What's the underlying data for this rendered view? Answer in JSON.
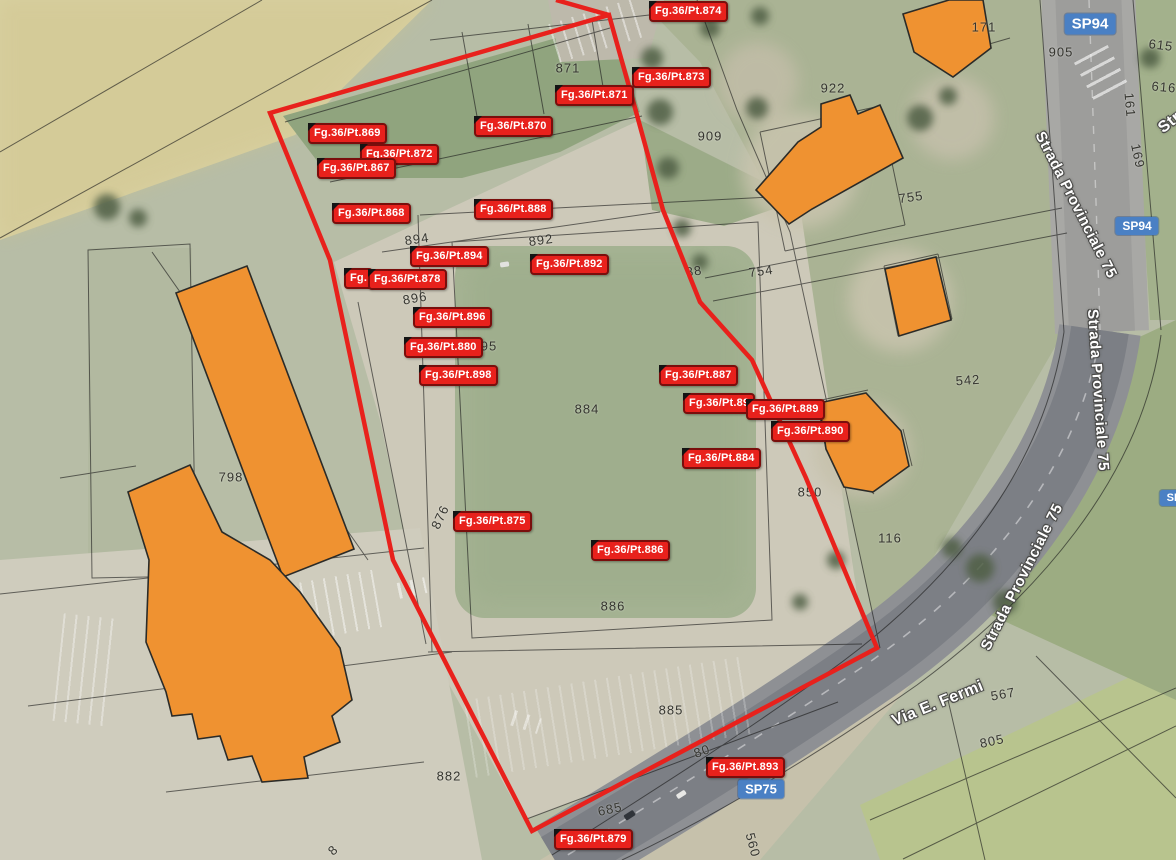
{
  "map": {
    "type": "cadastral-satellite-view",
    "colors": {
      "parcel_label_red": "#e8211c",
      "parcel_label_border": "#7a0e0c",
      "boundary_red": "#e8211c",
      "badge_blue": "#4a80c4",
      "building_orange": "#ef9231",
      "cadastral_line": "#1a1a1a"
    },
    "red_boundary": {
      "main": "M270,113 L609,15 L635,108 L663,210 L700,302 L752,360 L806,478 L877,648 L532,831 L393,560 L330,260 Z",
      "spur": "M556,0 L609,15"
    },
    "buildings": [
      {
        "id": "ne-corner",
        "points": "903,14 949,0 983,0 991,48 953,77 914,52"
      },
      {
        "id": "north-755",
        "points": "756,190 798,142 821,127 821,104 850,95 858,114 880,105 903,158 812,209 789,224 770,204"
      },
      {
        "id": "east-square",
        "points": "885,269 936,257 951,320 899,336"
      },
      {
        "id": "east-850",
        "points": "819,403 866,393 901,431 909,466 873,492 844,487 826,449"
      },
      {
        "id": "west-long-slab",
        "points": "176,293 247,266 354,549 283,577"
      },
      {
        "id": "west-complex",
        "points": "128,492 190,465 222,532 270,560 300,592 340,648 352,700 332,716 340,742 304,757 308,778 262,782 252,756 228,760 220,736 198,739 192,714 172,716 166,692 146,642 149,560"
      }
    ],
    "cadastral_labels": [
      {
        "text": "Fg.36/Pt.874",
        "x": 649,
        "y": 1
      },
      {
        "text": "Fg.36/Pt.873",
        "x": 632,
        "y": 67
      },
      {
        "text": "Fg.36/Pt.871",
        "x": 555,
        "y": 85
      },
      {
        "text": "Fg.36/Pt.870",
        "x": 474,
        "y": 116
      },
      {
        "text": "Fg.36/Pt.869",
        "x": 308,
        "y": 123
      },
      {
        "text": "Fg.36/Pt.872",
        "x": 360,
        "y": 144
      },
      {
        "text": "Fg.36/Pt.867",
        "x": 317,
        "y": 158
      },
      {
        "text": "Fg.36/Pt.868",
        "x": 332,
        "y": 203
      },
      {
        "text": "Fg.36/Pt.888",
        "x": 474,
        "y": 199
      },
      {
        "text": "Fg.36/Pt.894",
        "x": 410,
        "y": 246
      },
      {
        "text": "Fg.",
        "x": 344,
        "y": 268
      },
      {
        "text": "Fg.36/Pt.878",
        "x": 368,
        "y": 269
      },
      {
        "text": "Fg.36/Pt.892",
        "x": 530,
        "y": 254
      },
      {
        "text": "Fg.36/Pt.896",
        "x": 413,
        "y": 307
      },
      {
        "text": "Fg.36/Pt.880",
        "x": 404,
        "y": 337
      },
      {
        "text": "Fg.36/Pt.898",
        "x": 419,
        "y": 365
      },
      {
        "text": "Fg.36/Pt.887",
        "x": 659,
        "y": 365
      },
      {
        "text": "Fg.36/Pt.89",
        "x": 683,
        "y": 393
      },
      {
        "text": "Fg.36/Pt.890",
        "x": 771,
        "y": 421
      },
      {
        "text": "Fg.36/Pt.889",
        "x": 746,
        "y": 399
      },
      {
        "text": "Fg.36/Pt.884",
        "x": 682,
        "y": 448
      },
      {
        "text": "Fg.36/Pt.875",
        "x": 453,
        "y": 511
      },
      {
        "text": "Fg.36/Pt.886",
        "x": 591,
        "y": 540
      },
      {
        "text": "Fg.36/Pt.893",
        "x": 706,
        "y": 757
      },
      {
        "text": "Fg.36/Pt.879",
        "x": 554,
        "y": 829
      }
    ],
    "parcel_numbers": [
      {
        "text": "871",
        "x": 568,
        "y": 68
      },
      {
        "text": "922",
        "x": 833,
        "y": 88
      },
      {
        "text": "909",
        "x": 710,
        "y": 136
      },
      {
        "text": "171",
        "x": 984,
        "y": 27
      },
      {
        "text": "905",
        "x": 1061,
        "y": 52
      },
      {
        "text": "615",
        "x": 1161,
        "y": 45,
        "rot": 7
      },
      {
        "text": "616",
        "x": 1164,
        "y": 87,
        "rot": 5
      },
      {
        "text": "161",
        "x": 1130,
        "y": 105,
        "rot": 85
      },
      {
        "text": "169",
        "x": 1138,
        "y": 156,
        "rot": 78
      },
      {
        "text": "755",
        "x": 911,
        "y": 197,
        "rot": -8
      },
      {
        "text": "754",
        "x": 761,
        "y": 271,
        "rot": -8
      },
      {
        "text": "88",
        "x": 694,
        "y": 271,
        "rot": -8
      },
      {
        "text": "894",
        "x": 417,
        "y": 239,
        "rot": -8
      },
      {
        "text": "892",
        "x": 541,
        "y": 240,
        "rot": -8
      },
      {
        "text": "896",
        "x": 415,
        "y": 298,
        "rot": -10
      },
      {
        "text": "95",
        "x": 489,
        "y": 346
      },
      {
        "text": "884",
        "x": 587,
        "y": 409
      },
      {
        "text": "850",
        "x": 810,
        "y": 492
      },
      {
        "text": "542",
        "x": 968,
        "y": 380,
        "rot": -4
      },
      {
        "text": "116",
        "x": 890,
        "y": 538
      },
      {
        "text": "798",
        "x": 231,
        "y": 477
      },
      {
        "text": "876",
        "x": 440,
        "y": 517,
        "rot": -65
      },
      {
        "text": "886",
        "x": 613,
        "y": 606
      },
      {
        "text": "885",
        "x": 671,
        "y": 710
      },
      {
        "text": "882",
        "x": 449,
        "y": 776
      },
      {
        "text": "685",
        "x": 610,
        "y": 809,
        "rot": -12
      },
      {
        "text": "80",
        "x": 702,
        "y": 751,
        "rot": -20
      },
      {
        "text": "567",
        "x": 1003,
        "y": 694,
        "rot": -10
      },
      {
        "text": "805",
        "x": 992,
        "y": 741,
        "rot": -12
      },
      {
        "text": "560",
        "x": 753,
        "y": 845,
        "rot": 75
      },
      {
        "text": "8",
        "x": 333,
        "y": 850,
        "rot": -45
      }
    ],
    "road_badges": [
      {
        "text": "SP94",
        "x": 1090,
        "y": 24,
        "size": 15
      },
      {
        "text": "SP94",
        "x": 1137,
        "y": 226,
        "size": 12
      },
      {
        "text": "SP75",
        "x": 761,
        "y": 789,
        "size": 13
      },
      {
        "text": "SP",
        "x": 1174,
        "y": 498,
        "size": 11
      }
    ],
    "road_names": [
      {
        "text": "Strada Provinciale 75",
        "x": 1076,
        "y": 205,
        "rot": 63,
        "size": 15
      },
      {
        "text": "Strada Provinciale 75",
        "x": 1098,
        "y": 390,
        "rot": 86,
        "size": 15
      },
      {
        "text": "Strada Provinciale 75",
        "x": 1022,
        "y": 577,
        "rot": -63,
        "size": 15
      },
      {
        "text": "Via E. Fermi",
        "x": 938,
        "y": 704,
        "rot": -22,
        "size": 16
      },
      {
        "text": "Str",
        "x": 1170,
        "y": 123,
        "rot": -38,
        "size": 16
      }
    ]
  }
}
